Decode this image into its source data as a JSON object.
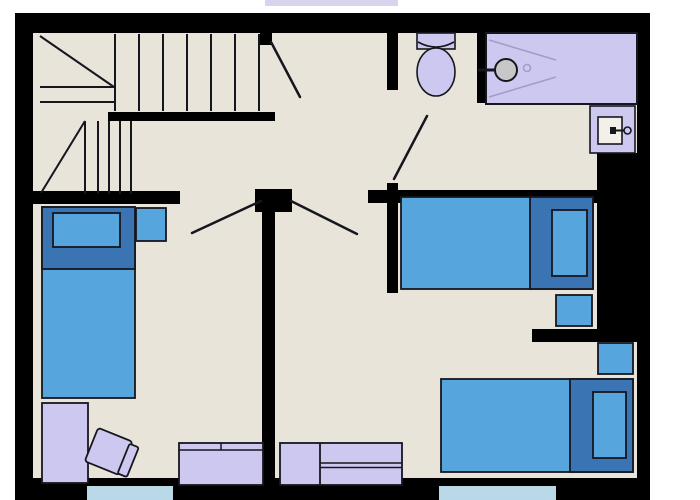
{
  "colors": {
    "background": "#ffffff",
    "wall": "#000000",
    "floor": "#e8e4da",
    "outline": "#16161e",
    "bed_blue": "#56a5dc",
    "bed_dark_blue": "#3b74b2",
    "furniture_lavender": "#cdc8f0",
    "shower_line_lavender": "#a29cc6",
    "shower_head_gray": "#c7c7c7",
    "sink_basin": "#f3f0ea",
    "window_blue": "#b9d9e8",
    "skylight_lavender": "#d9d4ee"
  },
  "plan": {
    "fixture_icons": [
      "staircase-icon",
      "stair-door-swing-icon",
      "bathroom-door-swing-icon",
      "bedroom-door-swing-icon",
      "toilet-icon",
      "shower-icon",
      "shower-head-icon",
      "drain-icon",
      "sink-icon",
      "faucet-icon"
    ],
    "furniture_icons": [
      "single-bed-icon",
      "pillow-icon",
      "nightstand-icon",
      "wardrobe-icon",
      "desk-chair-icon",
      "desk-icon",
      "dresser-icon",
      "window-icon"
    ]
  }
}
